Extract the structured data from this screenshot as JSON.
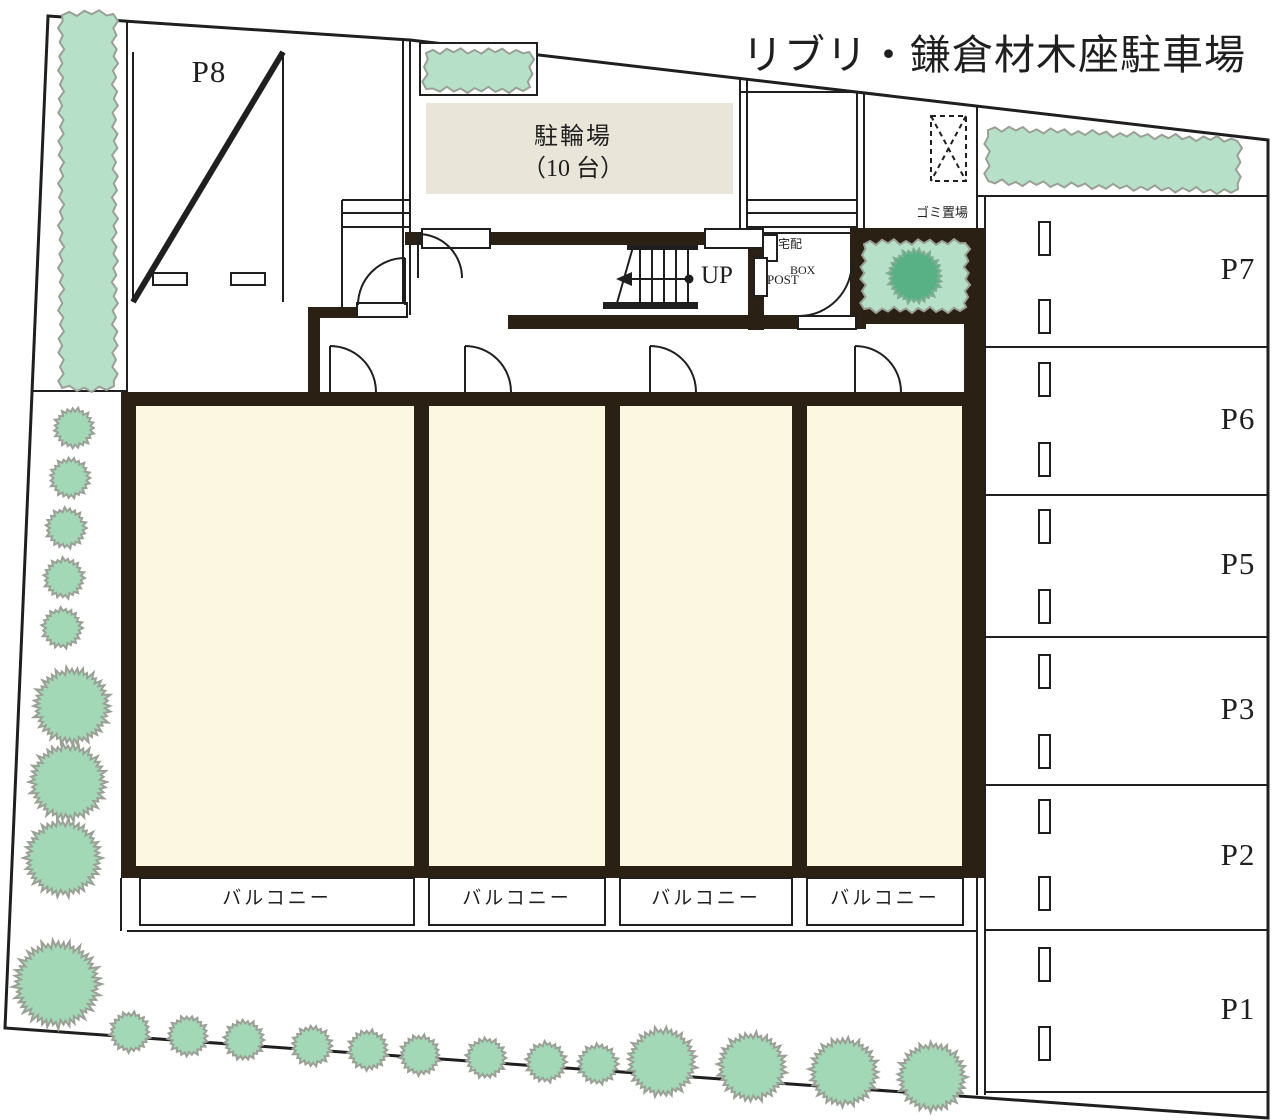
{
  "title": "リブリ・鎌倉材木座駐車場",
  "site": {
    "bicycle_parking": {
      "line1": "駐輪場",
      "line2": "（10 台）"
    },
    "garbage_area_label": "ゴミ置場",
    "delivery_box": {
      "line1": "宅配",
      "line2": "BOX"
    },
    "post_label": "POST",
    "stairs_up_label": "UP",
    "balcony_label": "バルコニー"
  },
  "parking": {
    "p8_label": "P8",
    "right_column": [
      {
        "label": "P7"
      },
      {
        "label": "P6"
      },
      {
        "label": "P5"
      },
      {
        "label": "P3"
      },
      {
        "label": "P2"
      },
      {
        "label": "P1"
      }
    ]
  },
  "colors": {
    "line": "#1f1f1f",
    "wall": "#2a2014",
    "room": "#fbf7e1",
    "bike_area": "#e9e5d9",
    "hedge": "#b7e0c8",
    "tree": "#a2d8b6",
    "tree_dark": "#57b184",
    "green_outline": "#9aa096"
  }
}
